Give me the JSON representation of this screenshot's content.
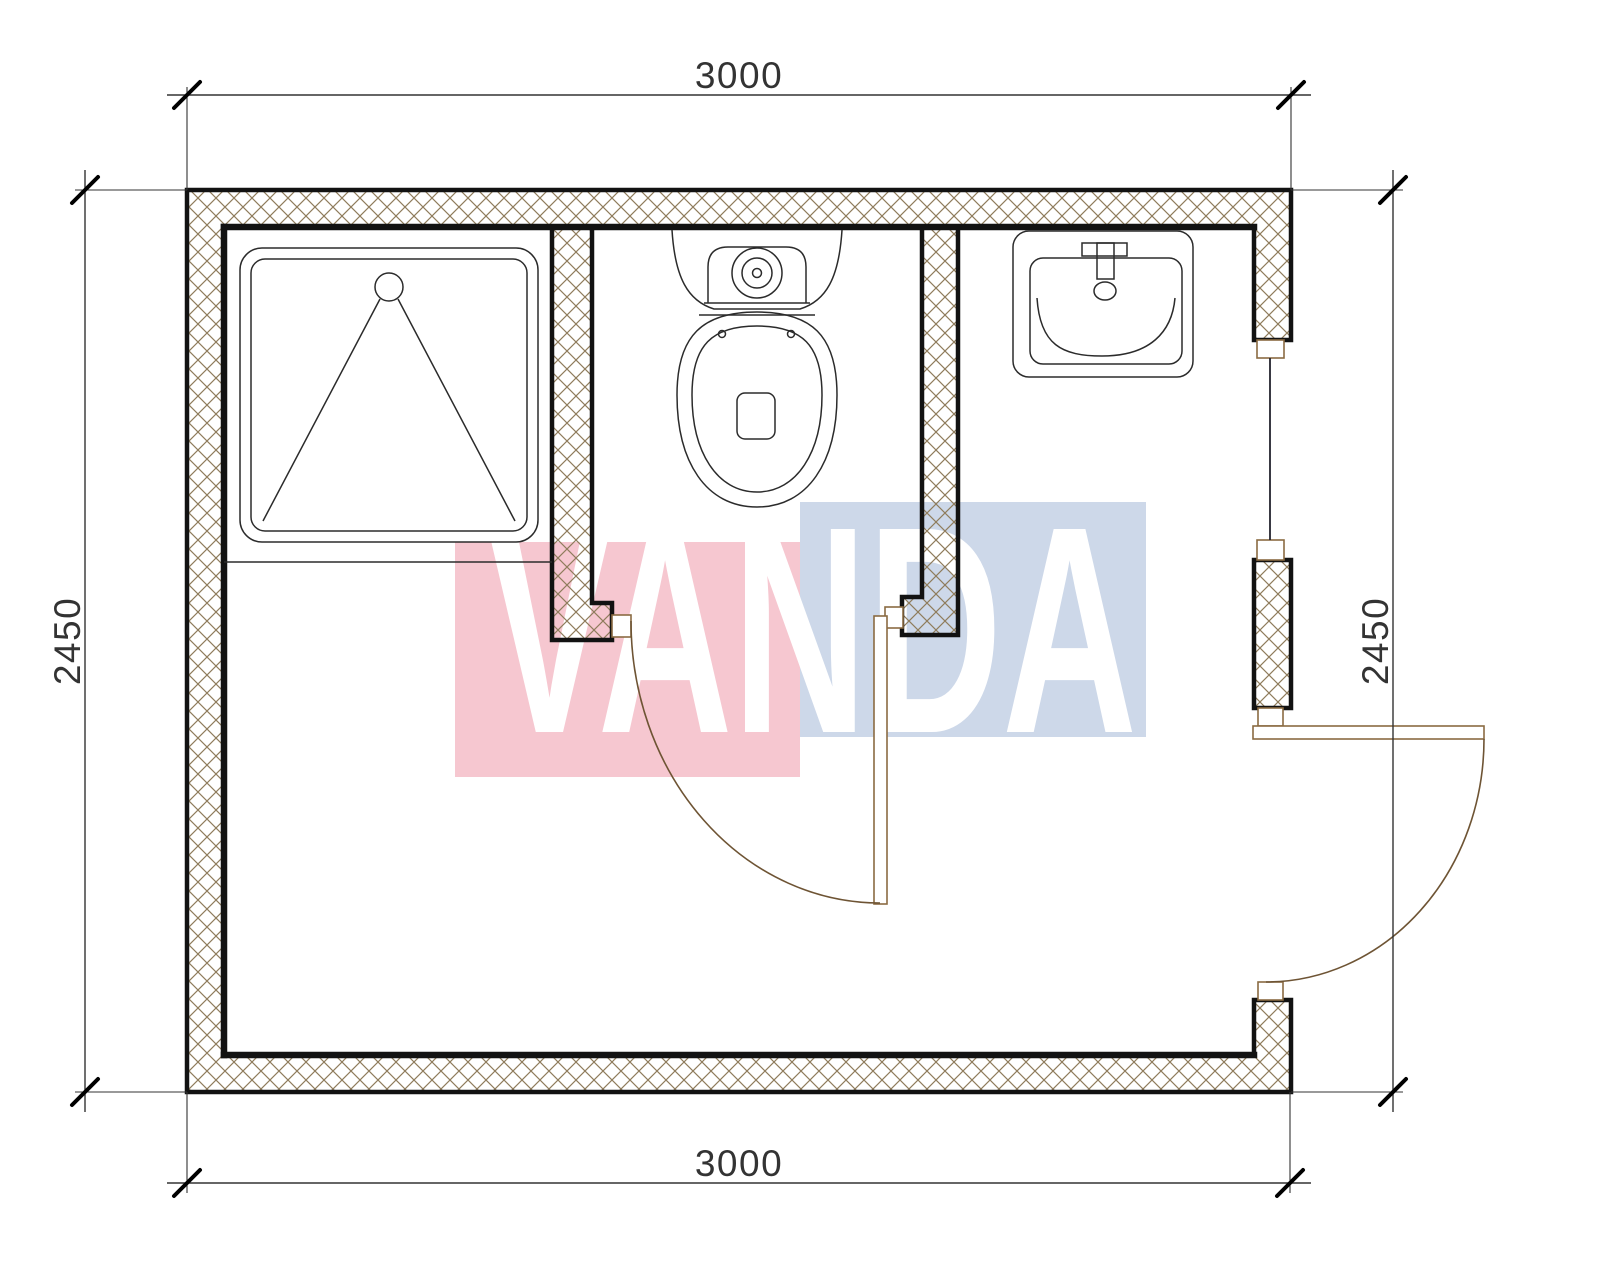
{
  "watermark": {
    "text": "VANDA"
  },
  "dims": {
    "top": "3000",
    "bottom": "3000",
    "left": "2450",
    "right": "2450"
  },
  "plan": {
    "fixture_icons": [
      "shower-tray-icon",
      "toilet-icon",
      "washbasin-icon"
    ],
    "door_icons": [
      "interior-door-swing-icon",
      "entry-door-swing-icon"
    ],
    "window_icons": [
      "window-icon"
    ]
  },
  "colors": {
    "wall_outline": "#121212",
    "hatch": "#8f7c5c",
    "dimension": "#333333",
    "tick": "#000000",
    "fixture": "#2b2b2b",
    "door_frame": "#8a6b42",
    "door_arc": "#6e5434",
    "window_line": "#23232e",
    "wm_pink": "#f6c7d0",
    "wm_blue": "#cdd8e9",
    "wm_text": "#ffffff",
    "background": "#ffffff"
  }
}
